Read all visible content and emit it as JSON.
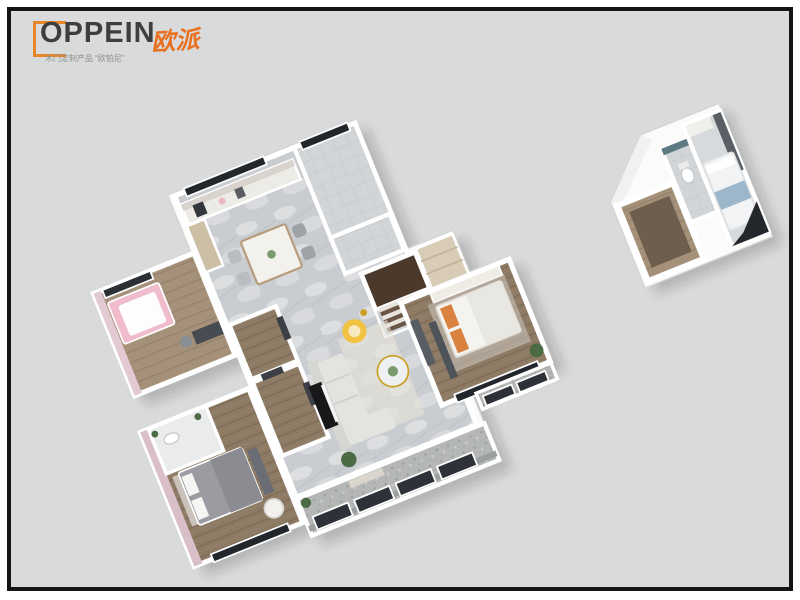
{
  "header": {
    "brand": "OPPEIN",
    "brand_cn": "欧派",
    "tagline": "木门定制产品 “欧铂尼”"
  },
  "scene": {
    "type": "3d-isometric-floorplan-render",
    "units": [
      "main-apartment",
      "annex-suite"
    ]
  },
  "colors": {
    "page": "#ffffff",
    "frame": "#141414",
    "canvas": "#d9dadb",
    "logo_orange": "#e8872a",
    "logo_cn_orange": "#e8701f",
    "logo_text": "#3d3e40",
    "tagline_gray": "#8f8f8f",
    "wall_white": "#fbfbfa",
    "floor_marble": "#c9ccd0",
    "floor_wood": "#8d7b66",
    "floor_wood_light": "#a5917a",
    "floor_stone": "#b4b7b5",
    "floor_tile": "#d2d5d7",
    "accent_pink": "#e2c3ce",
    "accent_yellow": "#f1c340",
    "window_dark": "#23262b",
    "stair_brown": "#4b3a2c",
    "cabinet_tan": "#d8ccb6",
    "plant_green": "#4c6b45",
    "bed_gray": "#9b9ba1",
    "bed_orange": "#d9813f",
    "annex_floor_brown": "#7b6a58",
    "annex_blue": "#9db6c9"
  }
}
